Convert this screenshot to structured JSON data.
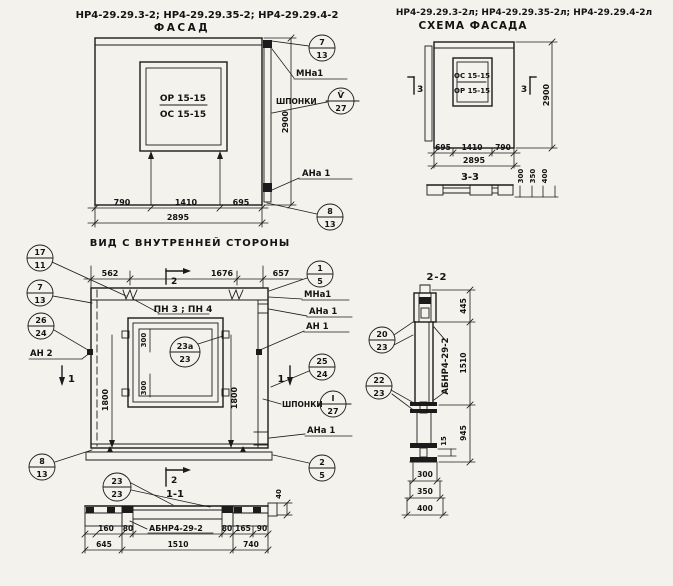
{
  "ink": "#1b1b1b",
  "paper": "#f4f2ec",
  "facade": {
    "codes": "НР4-29.29.3-2; НР4-29.29.35-2; НР4-29.29.4-2",
    "title": "ФАСАД",
    "window_top": "ОР 15-15",
    "window_bottom": "ОС 15-15",
    "dim_left": "790",
    "dim_mid": "1410",
    "dim_right": "695",
    "dim_total": "2895",
    "dim_height": "2900",
    "callout_top_num": "7",
    "callout_top_sheet": "13",
    "label_mna1": "МНа1",
    "label_shponki": "ШПОНКИ",
    "callout_key_num": "Ѷ",
    "callout_key_sheet": "27",
    "label_ana1": "АНа 1",
    "callout_bottom_num": "8",
    "callout_bottom_sheet": "13"
  },
  "scheme": {
    "codes": "НР4-29.29.3-2л; НР4-29.29.35-2л; НР4-29.29.4-2л",
    "title": "СХЕМА ФАСАДА",
    "window_top": "ОС 15-15",
    "window_bottom": "ОР 15-15",
    "section_mark": "3",
    "dim_left": "695",
    "dim_mid": "1410",
    "dim_right": "790",
    "dim_total": "2895",
    "dim_height": "2900",
    "section_title": "3-3",
    "profile_dims": [
      "300",
      "350",
      "400"
    ]
  },
  "inner": {
    "title": "ВИД С ВНУТРЕННЕЙ СТОРОНЫ",
    "dim_top_left": "562",
    "dim_top_mid": "1676",
    "dim_top_right": "657",
    "callout_17_num": "17",
    "callout_17_sheet": "11",
    "callout_7_num": "7",
    "callout_7_sheet": "13",
    "callout_26_num": "26",
    "callout_26_sheet": "24",
    "label_an2": "АН 2",
    "label_pn": "ПН 3 ; ПН 4",
    "dim_300": "300",
    "callout_23a_num": "23а",
    "callout_23a_sheet": "23",
    "dim_1800": "1800",
    "callout_1_num": "1",
    "callout_1_sheet": "5",
    "label_mna1": "МНа1",
    "label_ana1_top": "АНа 1",
    "label_an1": "АН 1",
    "callout_25_num": "25",
    "callout_25_sheet": "24",
    "label_shponki": "ШПОНКИ",
    "callout_key_num": "I",
    "callout_key_sheet": "27",
    "label_ana1_bottom": "АНа 1",
    "callout_2_num": "2",
    "callout_2_sheet": "5",
    "callout_8_num": "8",
    "callout_8_sheet": "13",
    "mark_1": "1",
    "mark_2": "2"
  },
  "section11": {
    "title": "1-1",
    "callout_23_num": "23",
    "callout_23_sheet": "23",
    "label_abnr": "АБНР4-29-2",
    "dim_40": "40",
    "dims_row1": [
      "160",
      "80",
      "80",
      "165",
      "90"
    ],
    "dims_row2": [
      "645",
      "1510",
      "740"
    ]
  },
  "section22": {
    "title": "2-2",
    "callout_20_num": "20",
    "callout_20_sheet": "23",
    "callout_22_num": "22",
    "callout_22_sheet": "23",
    "label_abnr": "АБНР4-29-2",
    "dim_top": "445",
    "dim_mid": "1510",
    "dim_bottom": "945",
    "dim_15": "15",
    "dims_bottom": [
      "300",
      "350",
      "400"
    ]
  }
}
